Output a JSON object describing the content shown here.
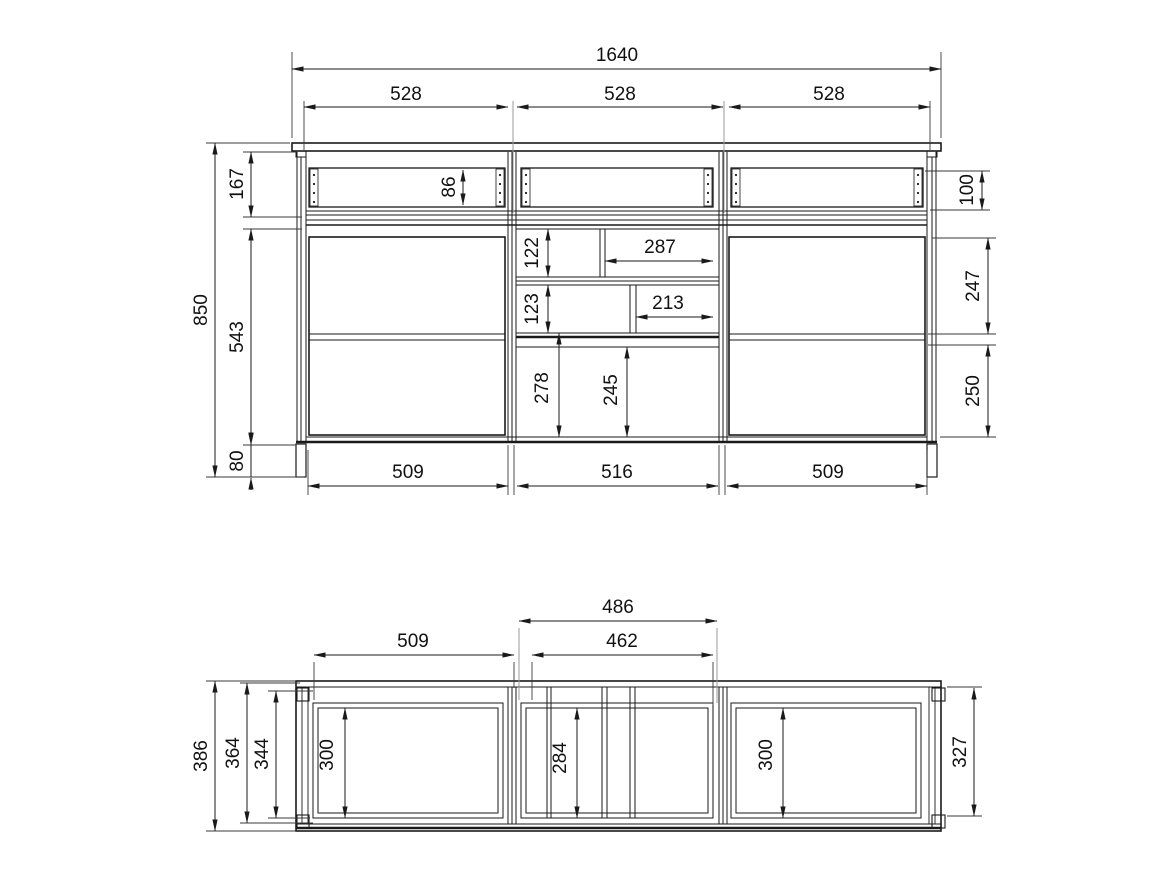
{
  "drawing": {
    "kind": "cabinet technical drawing, front elevation and plan view, dimensions in mm",
    "front": {
      "total_width": "1640",
      "bay_width_1": "528",
      "bay_width_2": "528",
      "bay_width_3": "528",
      "total_height": "850",
      "drawer_zone_height": "167",
      "door_zone_height": "543",
      "plinth_height": "80",
      "drawer_front_height": "86",
      "right_drawer_opening": "100",
      "right_upper_opening": "247",
      "right_lower_opening": "250",
      "niche_row1_height": "122",
      "niche_row1_width": "287",
      "niche_row2_height": "123",
      "niche_row2_width": "213",
      "lower_niche_height": "278",
      "lower_niche_clear": "245",
      "opening_width_left": "509",
      "opening_width_center": "516",
      "opening_width_right": "509"
    },
    "plan": {
      "left_opening_width": "509",
      "center_width_outer": "486",
      "center_width_inner": "462",
      "total_depth": "386",
      "inner_depth": "364",
      "frame_depth": "344",
      "left_clear_depth": "300",
      "center_clear_depth": "284",
      "right_clear_depth": "300",
      "right_inner_depth": "327"
    }
  }
}
